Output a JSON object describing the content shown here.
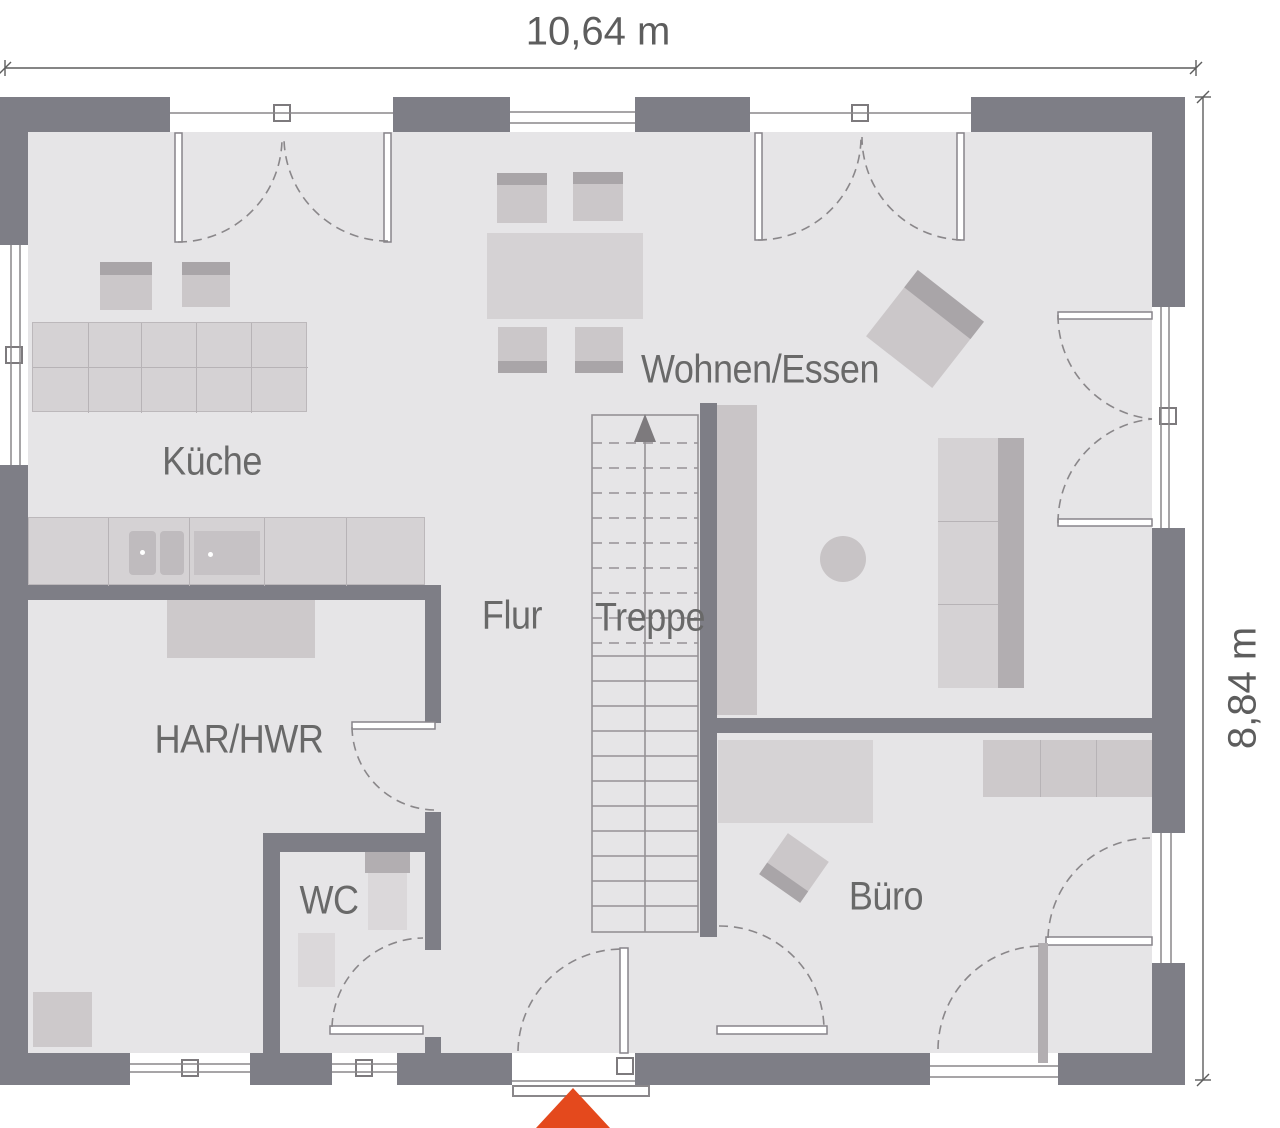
{
  "page": {
    "type": "floor-plan",
    "description": "ground floor plan with room labels and outer dimensions"
  },
  "dimensions": {
    "width_label": "10,64 m",
    "height_label": "8,84 m"
  },
  "rooms": {
    "kitchen": {
      "label": "Küche"
    },
    "living_dining": {
      "label": "Wohnen/Essen"
    },
    "hallway": {
      "label": "Flur"
    },
    "staircase": {
      "label": "Treppe"
    },
    "utility": {
      "label": "HAR/HWR"
    },
    "wc": {
      "label": "WC"
    },
    "office": {
      "label": "Büro"
    }
  },
  "icons": {
    "entrance_marker": "red-triangle-up",
    "stair_direction": "arrow-up"
  },
  "colors": {
    "wall": "#7e7e86",
    "floor": "#e6e5e7",
    "line": "#8a878a",
    "furn-light": "#d5d2d4",
    "furn-mid": "#cbc7c9",
    "furn-dark": "#a9a5a8",
    "accent": "#e4491d",
    "label": "#696969",
    "dim": "#5d5d5d"
  }
}
